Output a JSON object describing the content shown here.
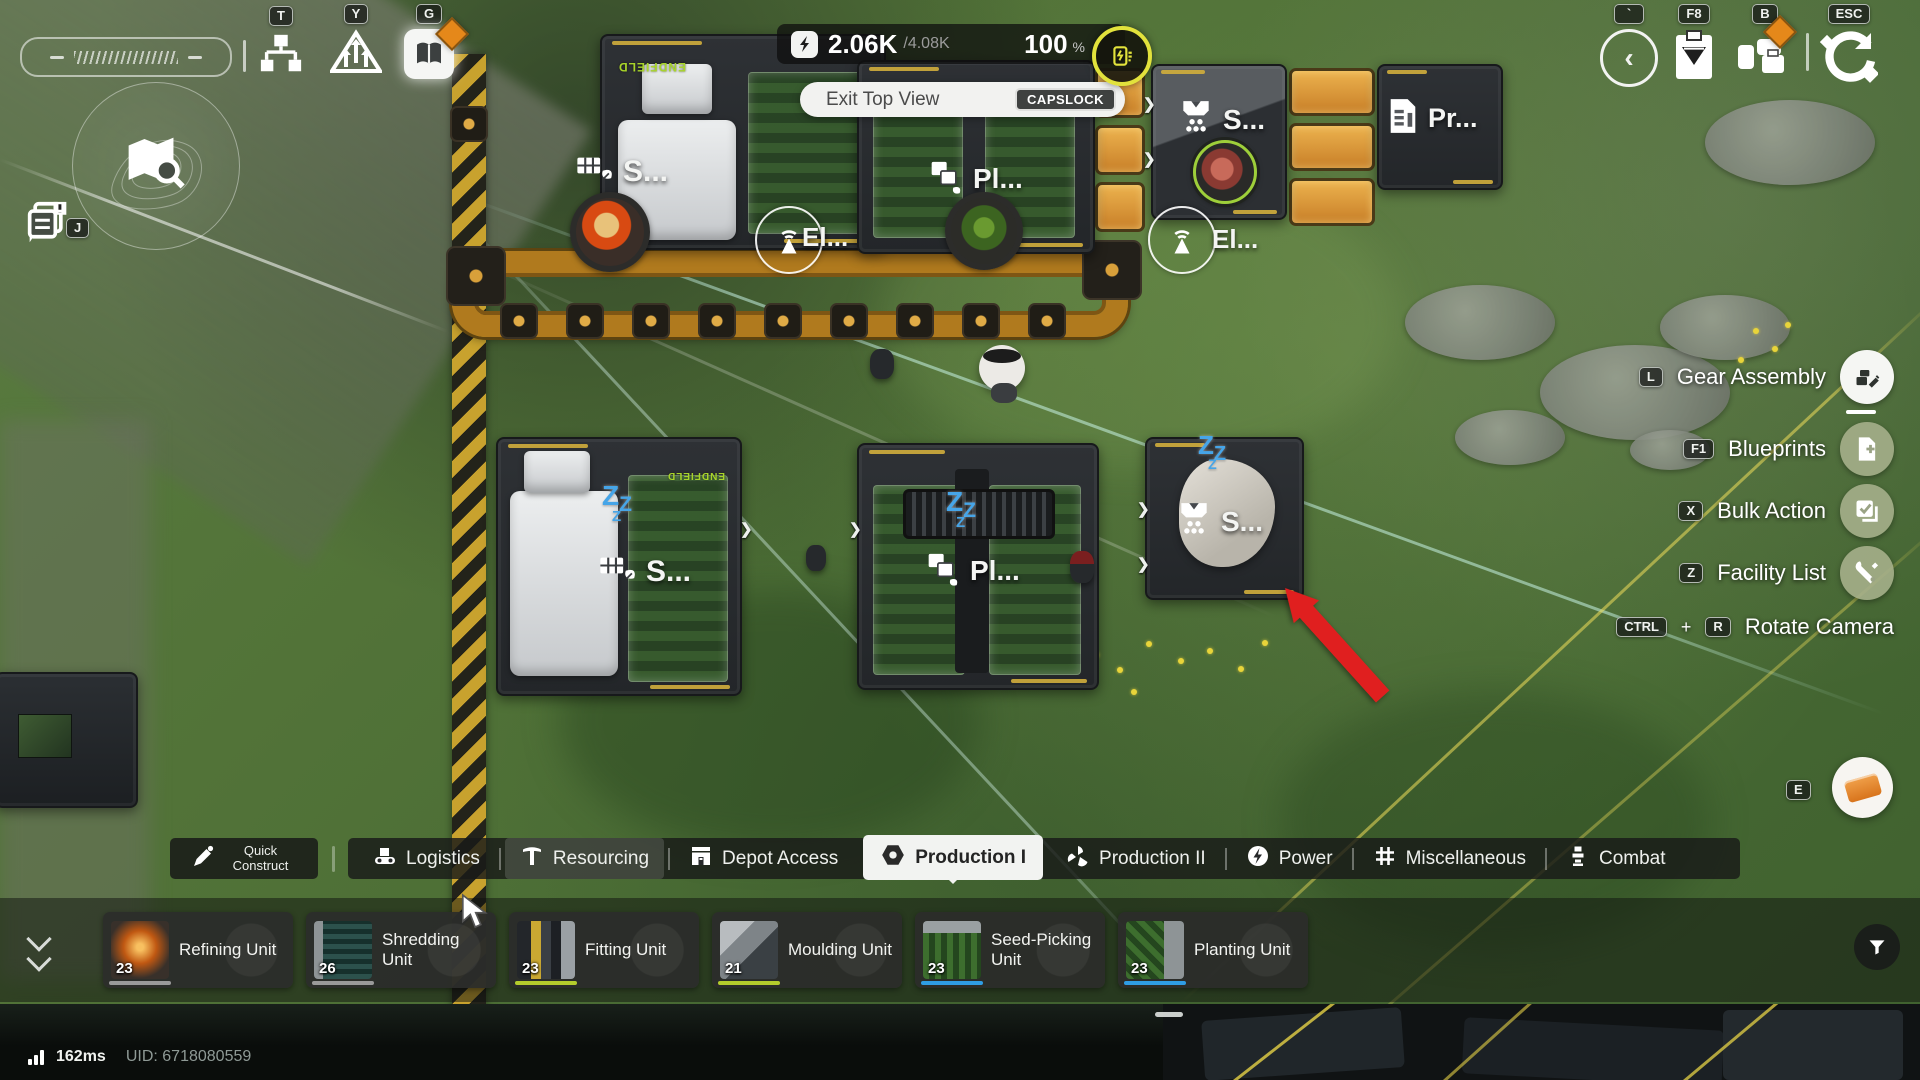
{
  "hud": {
    "topleft": {
      "key_t": "T",
      "key_y": "Y",
      "key_g": "G",
      "key_j": "J"
    },
    "power": {
      "current": "2.06K",
      "max": "/4.08K",
      "percent": "100",
      "unit": "%"
    },
    "exit": {
      "label": "Exit Top View",
      "key": "CAPSLOCK"
    },
    "topright": {
      "key_back": "`",
      "key_clipboard": "F8",
      "key_bag": "B",
      "key_esc": "ESC"
    },
    "menu": {
      "items": [
        {
          "key": "L",
          "label": "Gear Assembly"
        },
        {
          "key": "F1",
          "label": "Blueprints"
        },
        {
          "key": "X",
          "label": "Bulk Action"
        },
        {
          "key": "Z",
          "label": "Facility List"
        }
      ],
      "rotate": {
        "key_a": "CTRL",
        "plus": "+",
        "key_b": "R",
        "label": "Rotate Camera"
      }
    },
    "key_mail": "E"
  },
  "tabbar": {
    "quick_construct": "Quick Construct",
    "tabs": [
      "Logistics",
      "Resourcing",
      "Depot Access",
      "Production I",
      "Production II",
      "Power",
      "Miscellaneous",
      "Combat"
    ]
  },
  "cards": [
    {
      "name": "Refining Unit",
      "count": "23"
    },
    {
      "name": "Shredding Unit",
      "count": "26"
    },
    {
      "name": "Fitting Unit",
      "count": "23"
    },
    {
      "name": "Moulding Unit",
      "count": "21"
    },
    {
      "name": "Seed-Picking Unit",
      "count": "23"
    },
    {
      "name": "Planting Unit",
      "count": "23"
    }
  ],
  "status": {
    "ping": "162ms",
    "uid": "UID: 6718080559"
  },
  "world": {
    "endfield": "ENDFIELD",
    "zzz": "Z",
    "labels": {
      "seed_top": "S...",
      "plant_top": "Pl...",
      "shred_top": "S...",
      "printer": "Pr...",
      "el_left": "El...",
      "el_right": "El...",
      "seed_mid": "S...",
      "plant_mid": "Pl...",
      "shred_mid": "S..."
    }
  },
  "colors": {
    "accent_orange": "#e5881a",
    "zzz_blue": "#46a5e8",
    "underline_gray": "#9a9a9a",
    "underline_yellowgreen": "#b4cc2c",
    "underline_blue": "#2f9de4",
    "hazard_yellow": "#c8a22e",
    "conveyor_orange": "#b07a1e"
  }
}
